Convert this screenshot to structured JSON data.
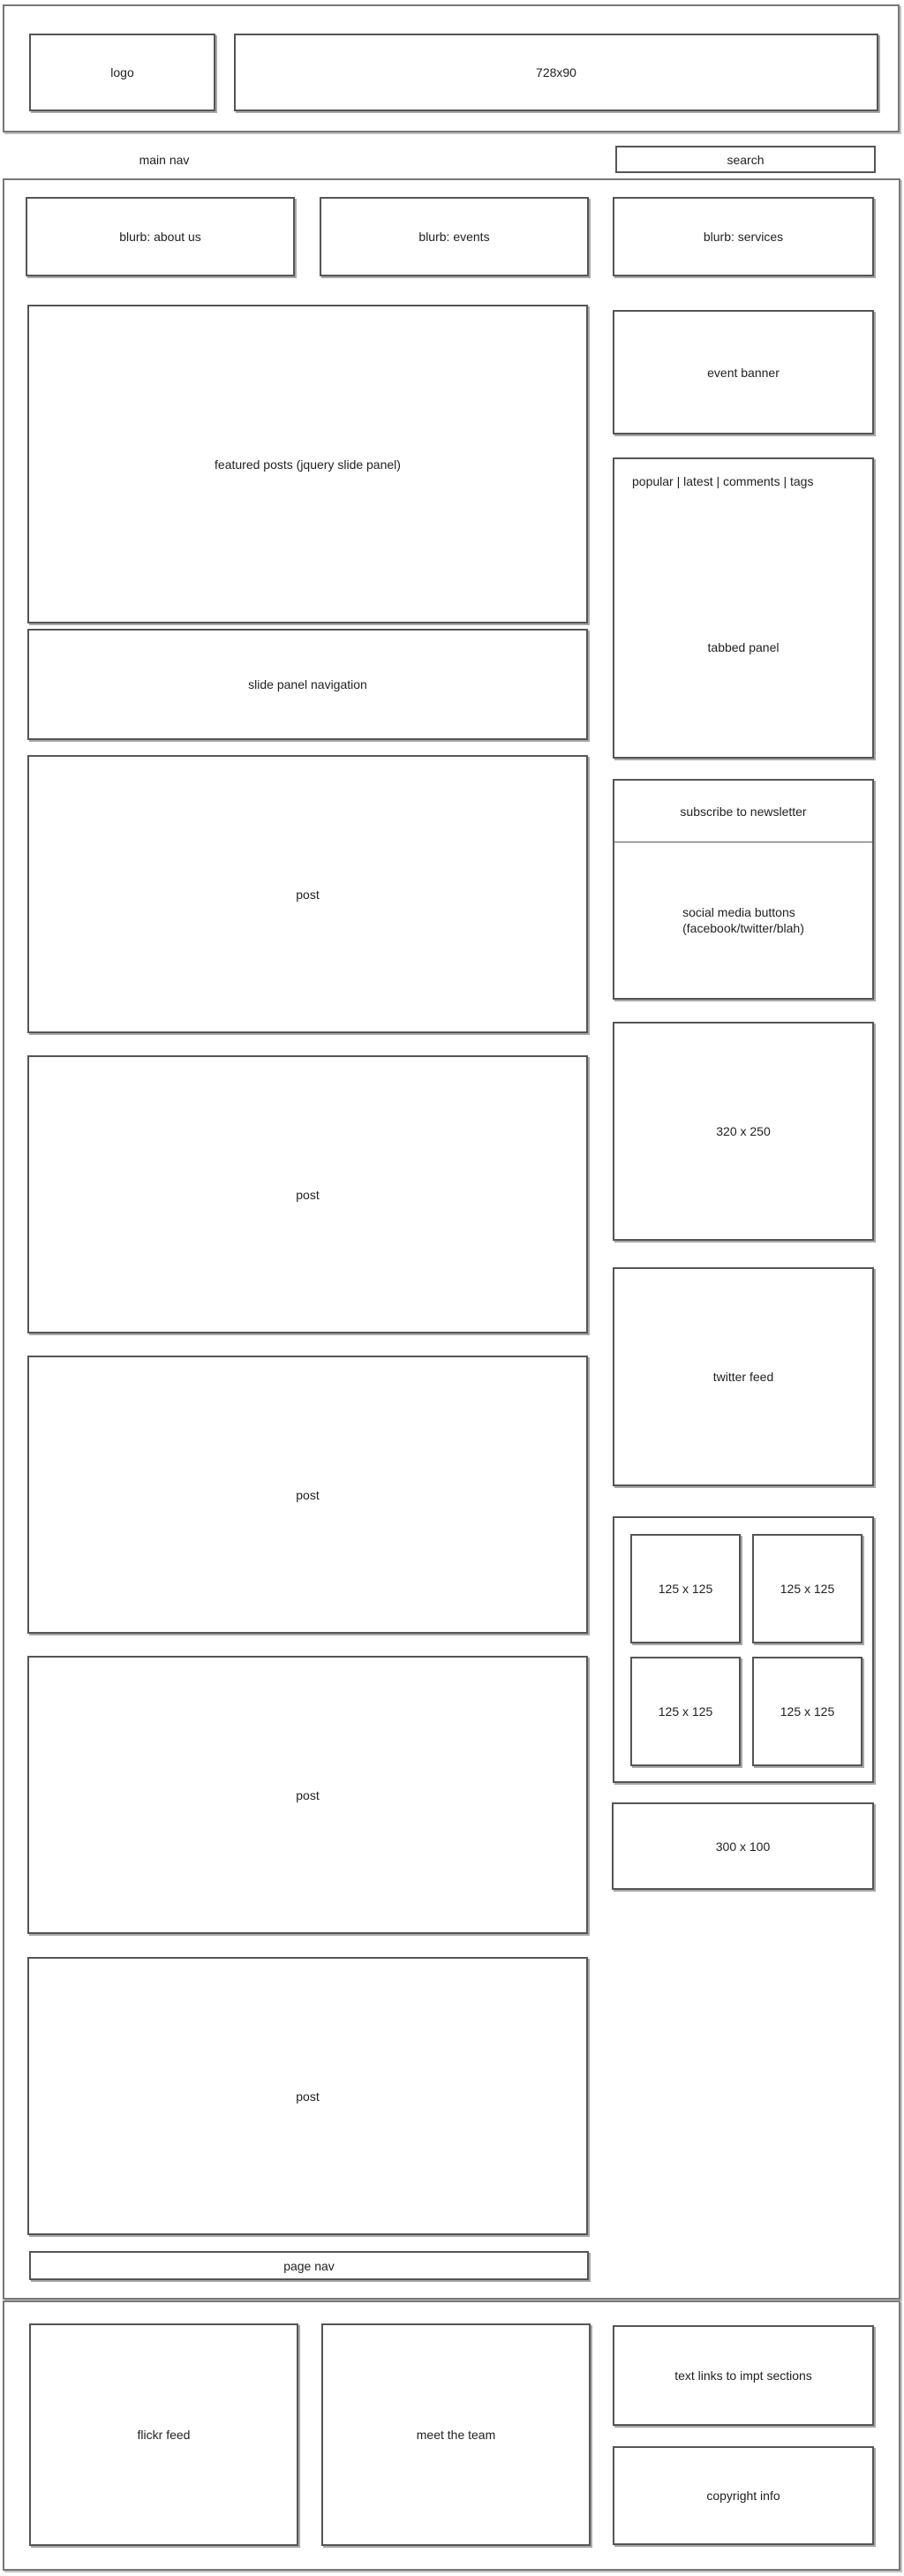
{
  "colors": {
    "background": "#ffffff",
    "box_border": "#555555",
    "outer_border": "#777777",
    "shadow": "#a8a8a8",
    "text": "#1f1f1f"
  },
  "header": {
    "logo_label": "logo",
    "banner_label": "728x90"
  },
  "nav": {
    "main_nav_label": "main nav",
    "search_label": "search"
  },
  "blurbs": {
    "about": "blurb: about us",
    "events": "blurb: events",
    "services": "blurb: services"
  },
  "content": {
    "featured_label": "featured posts (jquery slide panel)",
    "slide_nav_label": "slide panel navigation",
    "posts": [
      "post",
      "post",
      "post",
      "post",
      "post"
    ],
    "page_nav_label": "page nav"
  },
  "sidebar": {
    "event_banner_label": "event banner",
    "tabs_label": "popular | latest | comments | tags",
    "tabbed_panel_label": "tabbed panel",
    "subscribe_label": "subscribe to newsletter",
    "social_line1": "social media buttons",
    "social_line2": "(facebook/twitter/blah)",
    "ad_320_label": "320 x 250",
    "twitter_label": "twitter feed",
    "ads_125": [
      "125 x 125",
      "125 x 125",
      "125 x 125",
      "125 x 125"
    ],
    "ad_300_label": "300 x 100"
  },
  "footer": {
    "flickr_label": "flickr feed",
    "team_label": "meet the team",
    "links_label": "text links to impt sections",
    "copyright_label": "copyright info"
  }
}
